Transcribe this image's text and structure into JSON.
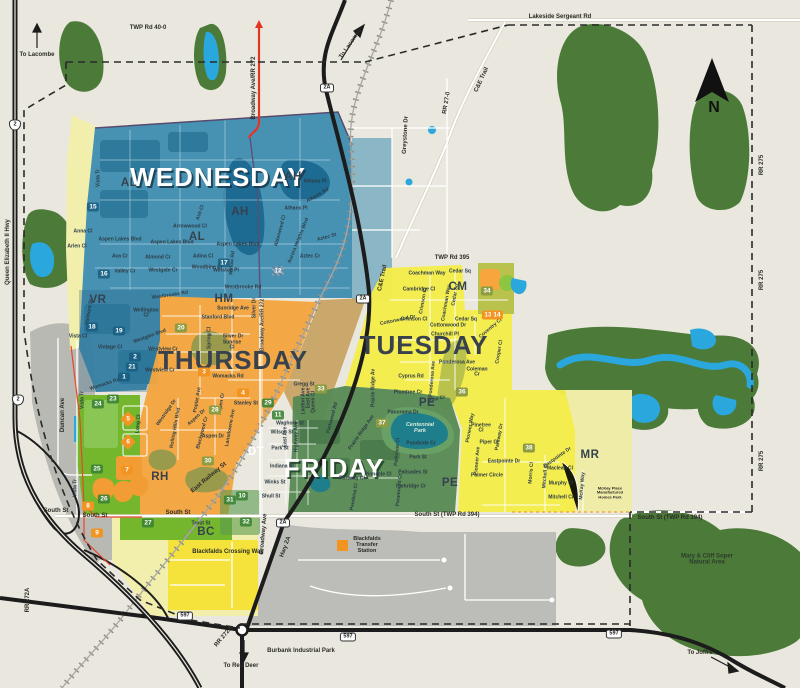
{
  "map": {
    "compass_label": "N",
    "zones": [
      {
        "id": "wednesday",
        "label": "WEDNESDAY",
        "color": "#3d8cb0",
        "style": "zt-light",
        "x": 218,
        "y": 177
      },
      {
        "id": "thursday",
        "label": "THURSDAY",
        "color": "#f4a63e",
        "style": "zt-dark",
        "x": 233,
        "y": 360
      },
      {
        "id": "tuesday",
        "label": "TUESDAY",
        "color": "#f4ec4a",
        "style": "zt-dark",
        "x": 424,
        "y": 345
      },
      {
        "id": "friday",
        "label": "FRIDAY",
        "color": "#578a54",
        "style": "zt-green",
        "x": 334,
        "y": 468
      }
    ],
    "labels": {
      "area_codes": [
        [
          "AH",
          293,
          177
        ],
        [
          "AH",
          240,
          212
        ],
        [
          "AL",
          129,
          183
        ],
        [
          "AL",
          197,
          237
        ],
        [
          "VR",
          98,
          300
        ],
        [
          "HM",
          224,
          299
        ],
        [
          "CM",
          458,
          287
        ],
        [
          "PE",
          427,
          403
        ],
        [
          "PE",
          450,
          483
        ],
        [
          "DT",
          256,
          452,
          "#ffffff"
        ],
        [
          "RH",
          160,
          477
        ],
        [
          "MR",
          590,
          455
        ],
        [
          "BC",
          206,
          532
        ]
      ],
      "road_labels": [
        [
          "TWP Rd 40-0",
          148,
          28,
          0
        ],
        [
          "Lakeside Sergeant Rd",
          560,
          17,
          0
        ],
        [
          "TWP Rd 395",
          452,
          258,
          0
        ],
        [
          "South St",
          56,
          511,
          0
        ],
        [
          "South St",
          95,
          516,
          0
        ],
        [
          "South St",
          178,
          513,
          0
        ],
        [
          "South St (TWP Rd 394)",
          447,
          515,
          0
        ],
        [
          "South St (TWP Rd 394)",
          670,
          518,
          0
        ],
        [
          "RR 275",
          762,
          165,
          -90
        ],
        [
          "RR 275",
          762,
          280,
          -90
        ],
        [
          "RR 275",
          762,
          461,
          -90
        ],
        [
          "Broadway Ave/RR 272",
          254,
          88,
          -90
        ],
        [
          "Queen Elizabeth II Hwy",
          8,
          252,
          -90
        ],
        [
          "C&E Trail",
          482,
          80,
          -65
        ],
        [
          "C&E Trail",
          383,
          278,
          -78
        ],
        [
          "RR 27-0",
          447,
          103,
          -80
        ],
        [
          "Greystone Dr",
          406,
          135,
          -87
        ],
        [
          "To Lacombe",
          37,
          55,
          0
        ],
        [
          "To Lacombe",
          351,
          44,
          -55
        ],
        [
          "To Red Deer",
          241,
          666,
          0
        ],
        [
          "To Joffre",
          700,
          653,
          0
        ],
        [
          "RR 272A",
          28,
          600,
          -90
        ],
        [
          "RR 272A",
          224,
          637,
          -50
        ],
        [
          "Hwy 2A",
          286,
          547,
          -70
        ],
        [
          "Broadway Ave",
          264,
          534,
          -85
        ],
        [
          "East Railway St",
          209,
          478,
          -40
        ],
        [
          "Blackfalds Crossing Way",
          228,
          552,
          0
        ],
        [
          "Burbank Industrial Park",
          301,
          651,
          0
        ],
        [
          "Duncan Ave",
          63,
          415,
          -90
        ]
      ],
      "street_labels": [
        [
          "Anna Cl",
          83,
          232,
          0
        ],
        [
          "Arlen Cl",
          77,
          247,
          0
        ],
        [
          "Vista Tr",
          99,
          178,
          -90
        ],
        [
          "Vista Tr",
          83,
          400,
          -90
        ],
        [
          "Vista Tr",
          76,
          488,
          -90
        ],
        [
          "Aspen Lakes Blvd",
          120,
          240,
          0
        ],
        [
          "Aspen Lakes Blvd",
          172,
          243,
          0
        ],
        [
          "Aspen Lakes Blvd",
          238,
          245,
          0
        ],
        [
          "Ava Cr",
          120,
          257,
          0
        ],
        [
          "Almond Cr",
          158,
          258,
          0
        ],
        [
          "Adina Cl",
          203,
          257,
          0
        ],
        [
          "Valley Cr",
          125,
          272,
          0
        ],
        [
          "Westgate Cr",
          163,
          271,
          0
        ],
        [
          "Woodbine Cl",
          207,
          268,
          0
        ],
        [
          "Westbrooke Rd",
          170,
          296,
          -8
        ],
        [
          "Westbrooke Rd",
          243,
          288,
          0
        ],
        [
          "Arrowwood Cl",
          190,
          227,
          0
        ],
        [
          "Ash Cl",
          201,
          213,
          -70
        ],
        [
          "Willow Rd",
          233,
          263,
          -85
        ],
        [
          "Winston Pl",
          226,
          271,
          0
        ],
        [
          "Athans Pl",
          315,
          182,
          0
        ],
        [
          "Athens Rd",
          318,
          196,
          -30
        ],
        [
          "Athans Pl",
          296,
          209,
          0
        ],
        [
          "Aurora Heights Blvd",
          299,
          241,
          -68
        ],
        [
          "Aztec St",
          327,
          238,
          -15
        ],
        [
          "Aztec Cr",
          310,
          257,
          0
        ],
        [
          "Alderwood Cl",
          281,
          231,
          -75
        ],
        [
          "Valmont St",
          90,
          312,
          -80
        ],
        [
          "Vista Cl",
          78,
          337,
          0
        ],
        [
          "Vintage Cl",
          110,
          348,
          0
        ],
        [
          "Wellington\nCl",
          146,
          314,
          0
        ],
        [
          "Westglen Blvd",
          150,
          337,
          -20
        ],
        [
          "Westview Cr",
          163,
          350,
          0
        ],
        [
          "Westview Cr",
          160,
          371,
          0
        ],
        [
          "Womacks Rd",
          105,
          385,
          -18
        ],
        [
          "Womacks Rd",
          228,
          377,
          0
        ],
        [
          "Sunridge Ave",
          233,
          309,
          0
        ],
        [
          "Stanford Blvd",
          218,
          318,
          0
        ],
        [
          "Silver Dr",
          233,
          337,
          0
        ],
        [
          "Silver Dr",
          255,
          308,
          -90
        ],
        [
          "Sunrise\nCl",
          232,
          346,
          0
        ],
        [
          "Spring Cl",
          210,
          338,
          -90
        ],
        [
          "Gregg St",
          304,
          385,
          0
        ],
        [
          "Stanley St",
          246,
          404,
          0
        ],
        [
          "Aspen Dr",
          197,
          418,
          -42
        ],
        [
          "Aspen Dr",
          213,
          437,
          0
        ],
        [
          "Aspen Cr",
          222,
          404,
          -80
        ],
        [
          "Poplar Ave",
          198,
          400,
          -80
        ],
        [
          "Lansdowne Ave",
          231,
          428,
          -80
        ],
        [
          "Rolling Hills Blvd",
          176,
          428,
          -80
        ],
        [
          "Westridge Dr",
          167,
          413,
          -55
        ],
        [
          "Blackwood Cr",
          203,
          433,
          -75
        ],
        [
          "Long Cl",
          139,
          424,
          -85
        ],
        [
          "Broadway Ave/RR 272",
          263,
          325,
          -90
        ],
        [
          "Waghorn St",
          290,
          424,
          0
        ],
        [
          "Wilson St",
          282,
          433,
          0
        ],
        [
          "Park St",
          280,
          449,
          0
        ],
        [
          "Indiana St",
          282,
          467,
          0
        ],
        [
          "Winks St",
          275,
          483,
          0
        ],
        [
          "Shull St",
          271,
          497,
          0
        ],
        [
          "East Ave",
          286,
          437,
          -90
        ],
        [
          "East Ave",
          309,
          398,
          -90
        ],
        [
          "Highway Ave",
          297,
          437,
          -90
        ],
        [
          "Lanton Ave",
          304,
          401,
          -90
        ],
        [
          "Queen Cl",
          314,
          402,
          -90
        ],
        [
          "Panorama Dr",
          403,
          413,
          0
        ],
        [
          "Pondside Cr",
          421,
          444,
          0
        ],
        [
          "Park St",
          418,
          458,
          0
        ],
        [
          "Palisades St",
          413,
          473,
          0
        ],
        [
          "Parkridge Cr",
          411,
          487,
          0
        ],
        [
          "Pinnacle Cl",
          378,
          475,
          0
        ],
        [
          "Portway Cl",
          352,
          479,
          0
        ],
        [
          "Pembina Cl",
          355,
          497,
          -80
        ],
        [
          "Parkwood Rd",
          333,
          418,
          -75
        ],
        [
          "Prairie Ridge Ave",
          362,
          433,
          -55
        ],
        [
          "Prairie Ridge Av",
          374,
          388,
          -90
        ],
        [
          "Parkview Cl",
          398,
          452,
          -85
        ],
        [
          "Paramount Cr",
          400,
          490,
          -85
        ],
        [
          "Pioneer Way",
          471,
          428,
          -80
        ],
        [
          "Pine Cr",
          437,
          400,
          -15
        ],
        [
          "Plumtree Cr",
          408,
          393,
          0
        ],
        [
          "Ponderosa Ave",
          457,
          363,
          0
        ],
        [
          "Ponderosa Ave",
          433,
          379,
          -85
        ],
        [
          "Cyprus Rd",
          411,
          377,
          0
        ],
        [
          "Coleman\nCr",
          477,
          373,
          0
        ],
        [
          "Cooper Cl",
          500,
          352,
          -80
        ],
        [
          "Coventry Cl",
          491,
          329,
          -40
        ],
        [
          "Churchill Pl",
          445,
          335,
          0
        ],
        [
          "Cottonwood Dr",
          398,
          321,
          -12
        ],
        [
          "Cottonwood Dr",
          448,
          326,
          0
        ],
        [
          "Crimson Cl",
          414,
          320,
          0
        ],
        [
          "Crimson Cl",
          424,
          301,
          -80
        ],
        [
          "Cambridge Cl",
          419,
          290,
          0
        ],
        [
          "Coachman Way",
          427,
          274,
          0
        ],
        [
          "Coachman Way",
          447,
          303,
          -80
        ],
        [
          "Cedar Sq",
          460,
          272,
          0
        ],
        [
          "Cedar Sq",
          466,
          320,
          0
        ],
        [
          "Cedar Sq",
          456,
          295,
          -80
        ],
        [
          "Pinetree\nCl",
          481,
          429,
          0
        ],
        [
          "Piper Cl",
          489,
          443,
          0
        ],
        [
          "Pioneer Ave",
          478,
          461,
          -85
        ],
        [
          "Parkway Dr",
          500,
          437,
          -80
        ],
        [
          "Eastpointe Dr",
          504,
          462,
          0
        ],
        [
          "Eastpointe Dr",
          558,
          458,
          -35
        ],
        [
          "Palmer Circle",
          487,
          476,
          0
        ],
        [
          "Maclean Cl",
          560,
          469,
          0
        ],
        [
          "Murphy Cl",
          561,
          484,
          0
        ],
        [
          "Mitchell Cr",
          561,
          498,
          0
        ],
        [
          "Mitchell Cl",
          546,
          476,
          -85
        ],
        [
          "Morris Cl",
          532,
          473,
          -85
        ],
        [
          "McKay Way",
          583,
          486,
          -85
        ],
        [
          "Trout St",
          201,
          524,
          0
        ]
      ],
      "place_labels": [
        [
          "Mary & Cliff Soper\nNatural Area",
          707,
          560,
          "#2b3b2b",
          6,
          0
        ],
        [
          "Blackfalds\nTransfer\nStation",
          367,
          546,
          "#2b2b26",
          5.5,
          0
        ],
        [
          "Centennial\nPark",
          420,
          429,
          "#d8ecdc",
          5.5,
          1
        ],
        [
          "McKay Place\nManufactured\nHomes Park",
          610,
          493,
          "#2b2b26",
          4,
          0
        ]
      ],
      "badges": [
        [
          "teal",
          "15",
          93,
          207
        ],
        [
          "teal",
          "16",
          104,
          274
        ],
        [
          "teal",
          "17",
          224,
          263
        ],
        [
          "teal",
          "18",
          92,
          327
        ],
        [
          "teal",
          "19",
          119,
          331
        ],
        [
          "teal",
          "2",
          135,
          357
        ],
        [
          "teal",
          "21",
          132,
          367
        ],
        [
          "teal",
          "1",
          124,
          377
        ],
        [
          "hatch",
          "12",
          278,
          271
        ],
        [
          "olive",
          "20",
          181,
          328
        ],
        [
          "olive",
          "28",
          215,
          410
        ],
        [
          "olive",
          "30",
          208,
          461
        ],
        [
          "olive",
          "33",
          321,
          389
        ],
        [
          "olive",
          "34",
          487,
          291
        ],
        [
          "olive",
          "36",
          462,
          392
        ],
        [
          "olive",
          "37",
          382,
          423
        ],
        [
          "olive",
          "38",
          529,
          448
        ],
        [
          "green",
          "24",
          98,
          404
        ],
        [
          "green",
          "23",
          113,
          399
        ],
        [
          "green",
          "25",
          97,
          469
        ],
        [
          "green",
          "26",
          104,
          499
        ],
        [
          "green",
          "27",
          148,
          523
        ],
        [
          "green",
          "31",
          230,
          500
        ],
        [
          "green",
          "32",
          246,
          522
        ],
        [
          "green",
          "29",
          268,
          403
        ],
        [
          "green",
          "11",
          278,
          415
        ],
        [
          "green",
          "10",
          242,
          496
        ],
        [
          "orange",
          "3",
          204,
          372
        ],
        [
          "orange",
          "4",
          243,
          393
        ],
        [
          "orange",
          "7",
          127,
          470
        ],
        [
          "orange",
          "8",
          88,
          506
        ],
        [
          "orange",
          "9",
          97,
          533
        ],
        [
          "orange",
          "13",
          488,
          315
        ],
        [
          "orange",
          "14",
          497,
          315
        ],
        [
          "diamond",
          "5",
          128,
          419
        ],
        [
          "diamond",
          "6",
          128,
          442
        ]
      ],
      "shields": [
        [
          "2",
          "2",
          15,
          125
        ],
        [
          "2",
          "2",
          18,
          400
        ],
        [
          "2A",
          "2A",
          327,
          88
        ],
        [
          "2A",
          "2A",
          363,
          299
        ],
        [
          "2A",
          "2A",
          283,
          523
        ],
        [
          "597",
          "597",
          185,
          616
        ],
        [
          "597",
          "597",
          348,
          637
        ],
        [
          "597",
          "597",
          614,
          634
        ]
      ]
    }
  }
}
